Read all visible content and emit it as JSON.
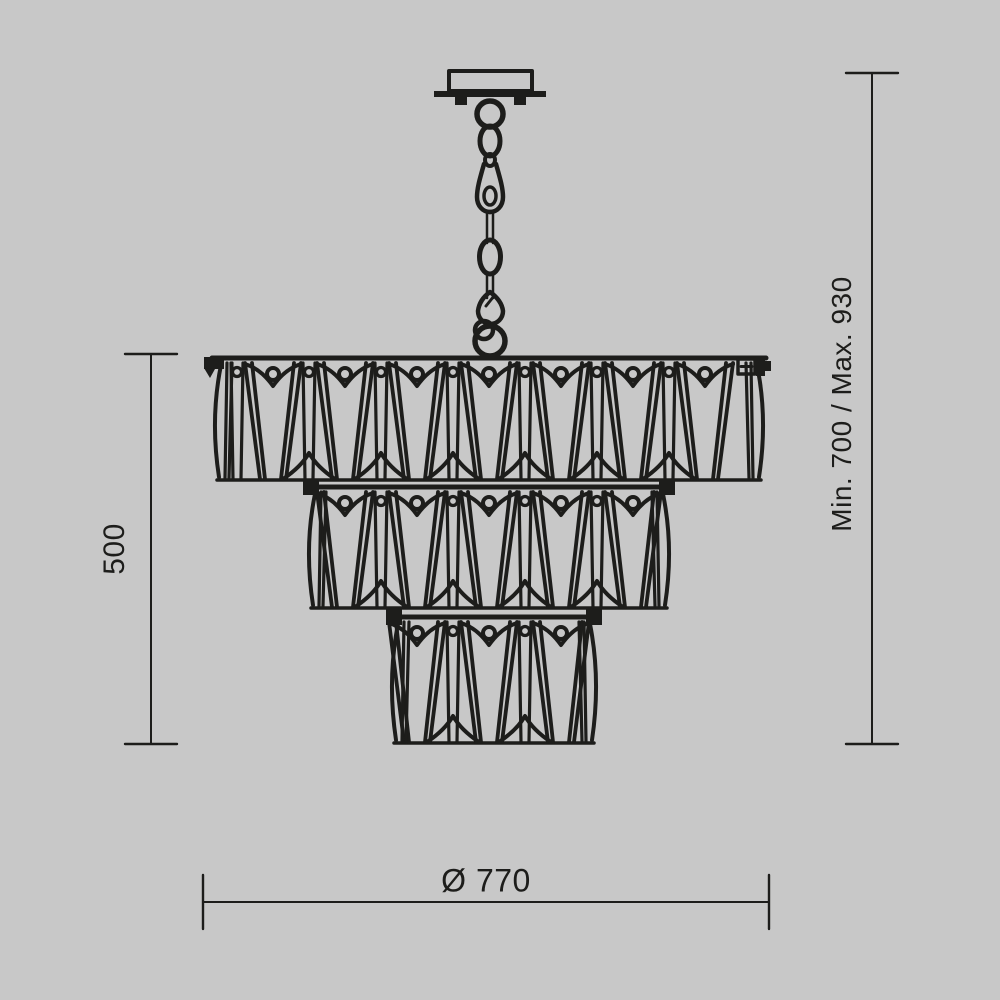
{
  "page": {
    "background": "#c8c8c8",
    "ink": "#1d1d1b"
  },
  "dimensions": {
    "body_height": {
      "value": "500",
      "side": "left",
      "orientation": "vertical"
    },
    "overall_height": {
      "value": "Min. 700 / Max. 930",
      "side": "right",
      "orientation": "vertical"
    },
    "diameter": {
      "value": "Ø 770",
      "side": "bottom",
      "orientation": "horizontal"
    }
  },
  "drawing": {
    "type": "technical-line-drawing",
    "subject": "three-tier crystal chandelier, front elevation with ceiling canopy and chain",
    "center_x": 489,
    "unit_width": 72,
    "canopy": {
      "x": 449,
      "y": 71,
      "width": 83,
      "height": 20,
      "plate": {
        "x": 434,
        "y": 91,
        "width": 112,
        "height": 6
      }
    },
    "chain": {
      "links": 7,
      "top_y": 100,
      "bottom_y": 356
    },
    "tiers": [
      {
        "label": "tier-1",
        "crystals": 7,
        "x0": 212,
        "x1": 766,
        "top": 358,
        "bottom": 480,
        "caps": "tab+bracket",
        "outer_narrow_left": true
      },
      {
        "label": "tier-2",
        "crystals": 5,
        "x0": 306,
        "x1": 672,
        "top": 487,
        "bottom": 608,
        "caps": "blocks",
        "outer_narrow_left": false
      },
      {
        "label": "tier-3",
        "crystals": 3,
        "x0": 389,
        "x1": 599,
        "top": 617,
        "bottom": 743,
        "caps": "blocks",
        "outer_narrow_left": false
      }
    ],
    "dimension_lines": {
      "left": {
        "x": 151,
        "y1": 354,
        "y2": 744,
        "tick_x1": 125,
        "tick_x2": 177
      },
      "right": {
        "x": 872,
        "y1": 73,
        "y2": 744,
        "tick_x1": 846,
        "tick_x2": 898
      },
      "bottom": {
        "y": 902,
        "x1": 203,
        "x2": 769,
        "tick_y1": 875,
        "tick_y2": 929
      }
    }
  }
}
